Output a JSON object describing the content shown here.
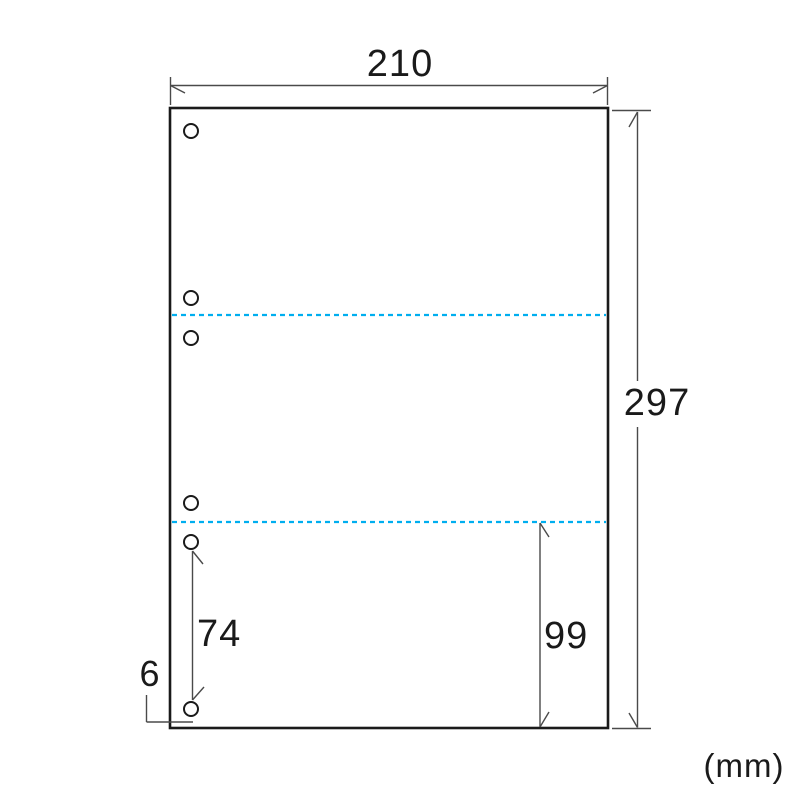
{
  "diagram": {
    "type": "dimensioned-technical-drawing",
    "description": "Sheet outline with 2 dashed perforation lines dividing it into 3 equal sections and 6 punch holes along the left edge",
    "unit_label": "(mm)",
    "labels": {
      "width": "210",
      "height": "297",
      "section_height": "99",
      "hole_gap": "74",
      "hole": "6"
    },
    "dimensions_mm": {
      "width": 210,
      "height": 297,
      "section_height": 99,
      "hole_gap": 74,
      "hole": 6
    },
    "perforation_line_count": 2,
    "punch_hole_count": 6,
    "colors": {
      "outline": "#1a1a1a",
      "dimension_line": "#4a4a4a",
      "perforation_line": "#00aeef",
      "background": "#ffffff"
    }
  }
}
